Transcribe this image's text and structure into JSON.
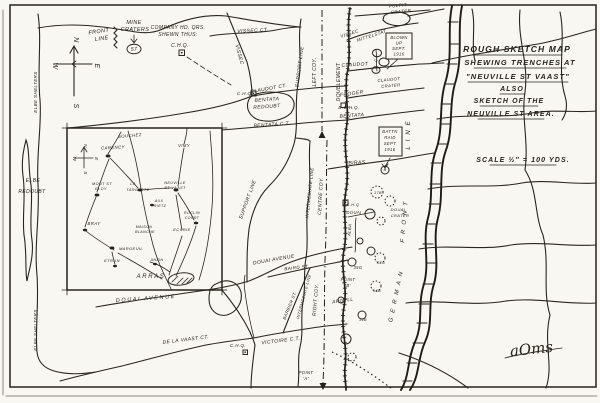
{
  "document": {
    "type": "hand-drawn trench sketch map",
    "ink_color": "#28231c",
    "paper_color": "#f8f7f1"
  },
  "title_block": {
    "line1": "ROUGH SKETCH MAP",
    "line2": "SHEWING TRENCHES AT",
    "line3": "\"NEUVILLE ST VAAST\"",
    "line4": "ALSO",
    "line5": "SKETCH OF THE",
    "line6": "NEUVILLE ST AREA.",
    "scale": "SCALE ½″ = 100 YDS."
  },
  "legend": {
    "front_line": "FRONT LINE",
    "mine_craters": "MINE CRATERS",
    "crater_number": "57",
    "company_hq": "COMPANY HD. QRS. SHEWN THUS:",
    "company_hq_symbol": "C.H.Q."
  },
  "compass": {
    "north": "N",
    "east": "E",
    "south": "S",
    "west": "W"
  },
  "signature": "aOms",
  "labels": [
    {
      "n": "legend-front-line-1",
      "t": "FRONT",
      "x": 99,
      "y": 33,
      "r": -8,
      "s": 5.5
    },
    {
      "n": "legend-front-line-2",
      "t": "LINE",
      "x": 102,
      "y": 40,
      "r": -8,
      "s": 5.5
    },
    {
      "n": "legend-mine-craters-1",
      "t": "MINE",
      "x": 134,
      "y": 24,
      "s": 5.5
    },
    {
      "n": "legend-mine-craters-2",
      "t": "CRATERS",
      "x": 135,
      "y": 31,
      "s": 5.5
    },
    {
      "n": "legend-crater-57",
      "t": "57",
      "x": 134,
      "y": 51,
      "s": 5
    },
    {
      "n": "legend-company-hq-1",
      "t": "COMPANY HD. QRS.",
      "x": 178,
      "y": 29,
      "s": 5
    },
    {
      "n": "legend-company-hq-2",
      "t": "SHEWN THUS:",
      "x": 178,
      "y": 36,
      "s": 5
    },
    {
      "n": "legend-chq",
      "t": "C.H.Q.",
      "x": 180,
      "y": 47,
      "s": 5
    },
    {
      "n": "compass-n",
      "t": "N",
      "x": 74,
      "y": 40,
      "r": 90,
      "s": 7
    },
    {
      "n": "compass-e",
      "t": "E",
      "x": 95,
      "y": 66,
      "r": 90,
      "s": 7
    },
    {
      "n": "compass-s",
      "t": "S",
      "x": 74,
      "y": 106,
      "r": 90,
      "s": 7
    },
    {
      "n": "compass-w",
      "t": "W",
      "x": 53,
      "y": 66,
      "r": 90,
      "s": 7
    },
    {
      "n": "title-1",
      "t": "ROUGH SKETCH MAP",
      "x": 517,
      "y": 52,
      "s": 8.5,
      "c": "title"
    },
    {
      "n": "title-2",
      "t": "SHEWING TRENCHES AT",
      "x": 520,
      "y": 65,
      "s": 7.5,
      "c": "title"
    },
    {
      "n": "title-3",
      "t": "\"NEUVILLE ST VAAST\"",
      "x": 518,
      "y": 79,
      "s": 7.5,
      "c": "title"
    },
    {
      "n": "title-4",
      "t": "ALSO",
      "x": 512,
      "y": 91,
      "s": 7,
      "c": "title"
    },
    {
      "n": "title-5",
      "t": "SKETCH OF THE",
      "x": 509,
      "y": 103,
      "s": 7,
      "c": "title"
    },
    {
      "n": "title-6",
      "t": "NEUVILLE ST AREA.",
      "x": 511,
      "y": 116,
      "s": 7,
      "c": "title"
    },
    {
      "n": "title-scale",
      "t": "SCALE ½″ = 100 YDS.",
      "x": 523,
      "y": 162,
      "s": 7,
      "c": "title"
    },
    {
      "n": "elbe-redoubt-1",
      "t": "ELBE",
      "x": 33,
      "y": 182,
      "s": 5
    },
    {
      "n": "elbe-redoubt-2",
      "t": "REDOUBT",
      "x": 32,
      "y": 193,
      "s": 5
    },
    {
      "n": "elbe-shelters-1",
      "t": "ELBE SHELTERS",
      "x": 37,
      "y": 92,
      "r": -90,
      "s": 4.5
    },
    {
      "n": "elbe-shelters-2",
      "t": "ELBE SHELTERS",
      "x": 37,
      "y": 330,
      "r": -90,
      "s": 4.5
    },
    {
      "n": "vissec-ct",
      "t": "VISSEC CT.",
      "x": 253,
      "y": 32,
      "r": -3,
      "s": 5
    },
    {
      "n": "vissec",
      "t": "VISSEC",
      "x": 238,
      "y": 55,
      "r": 75,
      "s": 5
    },
    {
      "n": "support-line-1",
      "t": "SUPPORT LINE",
      "x": 301,
      "y": 67,
      "r": -83,
      "s": 5
    },
    {
      "n": "support-line-2",
      "t": "SUPPORT LINE",
      "x": 249,
      "y": 200,
      "r": -70,
      "s": 5
    },
    {
      "n": "left-coy",
      "t": "LEFT COY.",
      "x": 316,
      "y": 72,
      "r": -90,
      "s": 5
    },
    {
      "n": "doublement",
      "t": "DOUBLEMENT",
      "x": 340,
      "y": 82,
      "r": -90,
      "s": 5
    },
    {
      "n": "vissec-2",
      "t": "VISSEC",
      "x": 350,
      "y": 35,
      "r": -18,
      "s": 4.5
    },
    {
      "n": "mittelstat",
      "t": "MITTELSTAT",
      "x": 372,
      "y": 37,
      "r": -18,
      "s": 4.5
    },
    {
      "n": "pulpit-crater-1",
      "t": "PULPIT",
      "x": 398,
      "y": 7,
      "r": -5,
      "s": 4.5
    },
    {
      "n": "pulpit-crater-2",
      "t": "CRATER",
      "x": 401,
      "y": 13,
      "r": -5,
      "s": 4.5
    },
    {
      "n": "blown-up-1",
      "t": "BLOWN",
      "x": 399,
      "y": 39,
      "s": 4.2
    },
    {
      "n": "blown-up-2",
      "t": "UP",
      "x": 399,
      "y": 44.5,
      "s": 4.2
    },
    {
      "n": "blown-up-3",
      "t": "SEPT.",
      "x": 399,
      "y": 50,
      "s": 4.2
    },
    {
      "n": "blown-up-4",
      "t": "1916",
      "x": 399,
      "y": 55.5,
      "s": 4.2
    },
    {
      "n": "claudot",
      "t": "CLAUDOT",
      "x": 355,
      "y": 66,
      "r": -3,
      "s": 5
    },
    {
      "n": "ct-small",
      "t": "C.T.",
      "x": 378,
      "y": 58,
      "r": -75,
      "s": 4
    },
    {
      "n": "claudot-crater-1",
      "t": "CLAUDOT",
      "x": 389,
      "y": 81,
      "r": -5,
      "s": 4.2
    },
    {
      "n": "claudot-crater-2",
      "t": "CRATER",
      "x": 391,
      "y": 87,
      "r": -5,
      "s": 4.2
    },
    {
      "n": "froger",
      "t": "FROGER",
      "x": 352,
      "y": 95,
      "r": -8,
      "s": 5
    },
    {
      "n": "bchq",
      "t": "B.C.H.Q.",
      "x": 349,
      "y": 109,
      "s": 4.5
    },
    {
      "n": "bentata-front",
      "t": "BENTATA",
      "x": 352,
      "y": 117,
      "r": -4,
      "s": 5
    },
    {
      "n": "claudot-ct",
      "t": "CLAUDOT CT.",
      "x": 269,
      "y": 90,
      "r": -10,
      "s": 5
    },
    {
      "n": "chq-map-1",
      "t": "C.H.Q.",
      "x": 245,
      "y": 95,
      "s": 4.5
    },
    {
      "n": "bentata-redoubt-1",
      "t": "BENTATA",
      "x": 267,
      "y": 101,
      "r": -4,
      "s": 5
    },
    {
      "n": "bentata-redoubt-2",
      "t": "REDOUBT",
      "x": 267,
      "y": 108,
      "r": -4,
      "s": 5
    },
    {
      "n": "bentata-ct",
      "t": "BENTATA C.T.",
      "x": 272,
      "y": 126,
      "r": -4,
      "s": 5
    },
    {
      "n": "biras",
      "t": "BIRAS",
      "x": 357,
      "y": 164,
      "r": -3,
      "s": 5
    },
    {
      "n": "battn-raid-1",
      "t": "BATTN",
      "x": 390,
      "y": 133,
      "s": 4.2
    },
    {
      "n": "battn-raid-2",
      "t": "RAID",
      "x": 390,
      "y": 139,
      "s": 4.2
    },
    {
      "n": "battn-raid-3",
      "t": "SEPT",
      "x": 390,
      "y": 145,
      "s": 4.2
    },
    {
      "n": "battn-raid-4",
      "t": "1916",
      "x": 390,
      "y": 151,
      "s": 4.2
    },
    {
      "n": "intermediate-line-1",
      "t": "INTERMEDIATE LINE",
      "x": 311,
      "y": 193,
      "r": -84,
      "s": 4.5
    },
    {
      "n": "centre-coy",
      "t": "CENTRE COY.",
      "x": 322,
      "y": 196,
      "r": -87,
      "s": 5
    },
    {
      "n": "german-line-line",
      "t": "LINE",
      "x": 410,
      "y": 133,
      "r": -90,
      "s": 6,
      "c": "sp"
    },
    {
      "n": "german-line-front",
      "t": "FRONT",
      "x": 406,
      "y": 220,
      "r": -85,
      "s": 6,
      "c": "sp"
    },
    {
      "n": "german-line-german",
      "t": "GERMAN",
      "x": 398,
      "y": 295,
      "r": -78,
      "s": 6,
      "c": "sp"
    },
    {
      "n": "alba",
      "t": "ALBA",
      "x": 351,
      "y": 230,
      "r": -85,
      "s": 4.2
    },
    {
      "n": "chq-douai",
      "t": "C.H.Q",
      "x": 353,
      "y": 206,
      "s": 4
    },
    {
      "n": "douai",
      "t": "DOUAI",
      "x": 354,
      "y": 214,
      "s": 4.2
    },
    {
      "n": "douai-crater-1",
      "t": "DOUAI",
      "x": 398,
      "y": 211,
      "s": 4
    },
    {
      "n": "douai-crater-2",
      "t": "CRATER",
      "x": 400,
      "y": 217,
      "s": 4
    },
    {
      "n": "crater-b",
      "t": "B",
      "x": 385,
      "y": 171,
      "s": 4
    },
    {
      "n": "crater-17b",
      "t": "17B",
      "x": 378,
      "y": 194,
      "s": 3.8
    },
    {
      "n": "crater-35g",
      "t": "35G",
      "x": 358,
      "y": 269,
      "s": 4.2
    },
    {
      "n": "crater-37g",
      "t": "37G",
      "x": 381,
      "y": 264,
      "s": 3.8
    },
    {
      "n": "crater-16b",
      "t": "16B",
      "x": 377,
      "y": 292,
      "s": 3.8
    },
    {
      "n": "crater-34b",
      "t": "34B",
      "x": 363,
      "y": 321,
      "s": 3.8
    },
    {
      "n": "point-b-1",
      "t": "POINT",
      "x": 348,
      "y": 281,
      "s": 4.2
    },
    {
      "n": "point-b-2",
      "t": "'B'",
      "x": 348,
      "y": 287,
      "s": 4.2
    },
    {
      "n": "argyll",
      "t": "ARGYLL",
      "x": 343,
      "y": 302,
      "r": -8,
      "s": 4.8
    },
    {
      "n": "douai-avenue-1",
      "t": "DOUAI AVENUE",
      "x": 146,
      "y": 300,
      "r": -4,
      "s": 5.5,
      "c": "ls"
    },
    {
      "n": "douai-avenue-2",
      "t": "DOUAI AVENUE",
      "x": 274,
      "y": 261,
      "r": -10,
      "s": 5
    },
    {
      "n": "baird-st",
      "t": "BAIRD ST.",
      "x": 297,
      "y": 269,
      "r": -6,
      "s": 4.5
    },
    {
      "n": "barbier-st",
      "t": "BARBIER ST.",
      "x": 291,
      "y": 306,
      "r": -68,
      "s": 4.2
    },
    {
      "n": "victoire-ct",
      "t": "VICTOIRE C.T.",
      "x": 281,
      "y": 342,
      "r": -7,
      "s": 5
    },
    {
      "n": "de-la-vaast-ct",
      "t": "DE LA VAAST CT.",
      "x": 186,
      "y": 341,
      "r": -7,
      "s": 5
    },
    {
      "n": "chq-map-2",
      "t": "C.H.Q.",
      "x": 238,
      "y": 347,
      "s": 4.5
    },
    {
      "n": "right-coy",
      "t": "RIGHT COY.",
      "x": 317,
      "y": 300,
      "r": -85,
      "s": 5
    },
    {
      "n": "intermediate-line-2",
      "t": "INTERMEDIATE LINE",
      "x": 305,
      "y": 297,
      "r": -75,
      "s": 4
    },
    {
      "n": "point-a-1",
      "t": "POINT",
      "x": 306,
      "y": 374,
      "s": 4.2
    },
    {
      "n": "point-a-2",
      "t": "'A'",
      "x": 306,
      "y": 380,
      "s": 4.2
    },
    {
      "n": "inset-souchez",
      "t": "SOUCHEZ",
      "x": 130,
      "y": 137,
      "r": -5,
      "s": 4.3
    },
    {
      "n": "inset-carency",
      "t": "CARENCY",
      "x": 113,
      "y": 149,
      "r": -3,
      "s": 4.3
    },
    {
      "n": "inset-vimy",
      "t": "VIMY",
      "x": 184,
      "y": 147,
      "s": 4.3
    },
    {
      "n": "inset-mont-st-eloy-1",
      "t": "MONT ST",
      "x": 102,
      "y": 185,
      "s": 3.8
    },
    {
      "n": "inset-mont-st-eloy-2",
      "t": "ELOY",
      "x": 101,
      "y": 190,
      "s": 3.8
    },
    {
      "n": "inset-la-targette-1",
      "t": "LA",
      "x": 133,
      "y": 185,
      "s": 3.8
    },
    {
      "n": "inset-la-targette-2",
      "t": "TARGETTE",
      "x": 138,
      "y": 191,
      "s": 3.8
    },
    {
      "n": "inset-neuville-1",
      "t": "NEUVILLE",
      "x": 175,
      "y": 184,
      "s": 3.8
    },
    {
      "n": "inset-neuville-2",
      "t": "ST VAAST",
      "x": 175,
      "y": 189,
      "s": 3.8
    },
    {
      "n": "inset-aux-rietz-1",
      "t": "AUX",
      "x": 159,
      "y": 202,
      "s": 3.6
    },
    {
      "n": "inset-aux-rietz-2",
      "t": "RIETZ",
      "x": 160,
      "y": 207,
      "s": 3.6
    },
    {
      "n": "inset-roclincourt-1",
      "t": "ROCLIN",
      "x": 192,
      "y": 214,
      "s": 3.6
    },
    {
      "n": "inset-roclincourt-2",
      "t": "COURT",
      "x": 192,
      "y": 219,
      "s": 3.6
    },
    {
      "n": "inset-ecurie",
      "t": "ECURIE",
      "x": 182,
      "y": 231,
      "s": 4
    },
    {
      "n": "inset-maison-blanche-1",
      "t": "MAISON",
      "x": 144,
      "y": 228,
      "s": 3.6
    },
    {
      "n": "inset-maison-blanche-2",
      "t": "BLANCHE",
      "x": 145,
      "y": 233,
      "s": 3.6
    },
    {
      "n": "inset-bray",
      "t": "BRAY",
      "x": 94,
      "y": 225,
      "s": 4.3
    },
    {
      "n": "inset-maroeuil",
      "t": "MAROEUIL",
      "x": 131,
      "y": 250,
      "s": 4
    },
    {
      "n": "inset-etrun",
      "t": "ETRUN",
      "x": 112,
      "y": 262,
      "s": 4
    },
    {
      "n": "inset-anzin",
      "t": "ANZIN",
      "x": 157,
      "y": 261,
      "s": 3.6
    },
    {
      "n": "inset-arras",
      "t": "ARRAS",
      "x": 151,
      "y": 278,
      "s": 6,
      "c": "ls"
    },
    {
      "n": "inset-compass-n",
      "t": "N",
      "x": 84,
      "y": 146,
      "r": 90,
      "s": 4.5
    },
    {
      "n": "inset-compass-e",
      "t": "E",
      "x": 95,
      "y": 159,
      "r": 90,
      "s": 4.5
    },
    {
      "n": "inset-compass-s",
      "t": "S",
      "x": 84,
      "y": 173,
      "r": 90,
      "s": 4.5
    },
    {
      "n": "inset-compass-w",
      "t": "W",
      "x": 73,
      "y": 159,
      "r": 90,
      "s": 4.5
    },
    {
      "n": "signature",
      "t": "aOms",
      "x": 532,
      "y": 354,
      "s": 15,
      "r": -6,
      "c": "sig"
    }
  ]
}
